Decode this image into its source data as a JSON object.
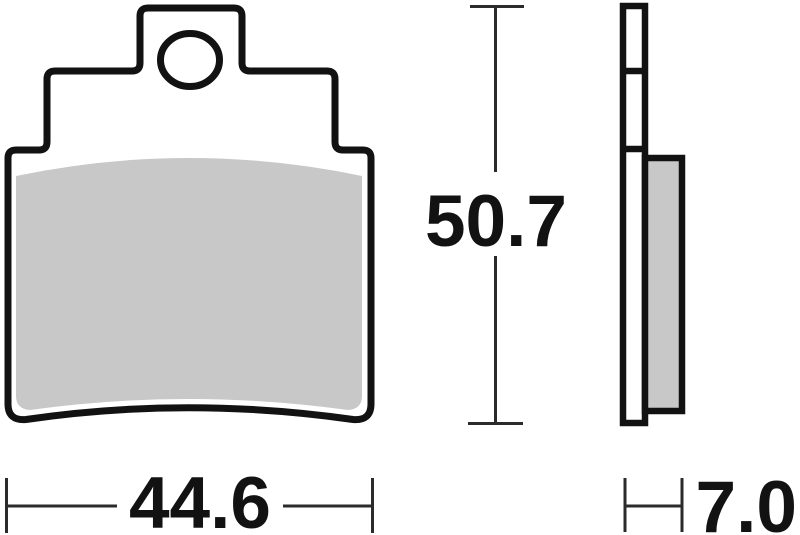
{
  "dimensions": {
    "width": "44.6",
    "height": "50.7",
    "thickness": "7.0"
  },
  "colors": {
    "outline": "#121212",
    "dimension_lines": "#2b2b2b",
    "friction_material": "#c8c8c8",
    "backplate_fill": "#ffffff",
    "background": "#ffffff"
  }
}
